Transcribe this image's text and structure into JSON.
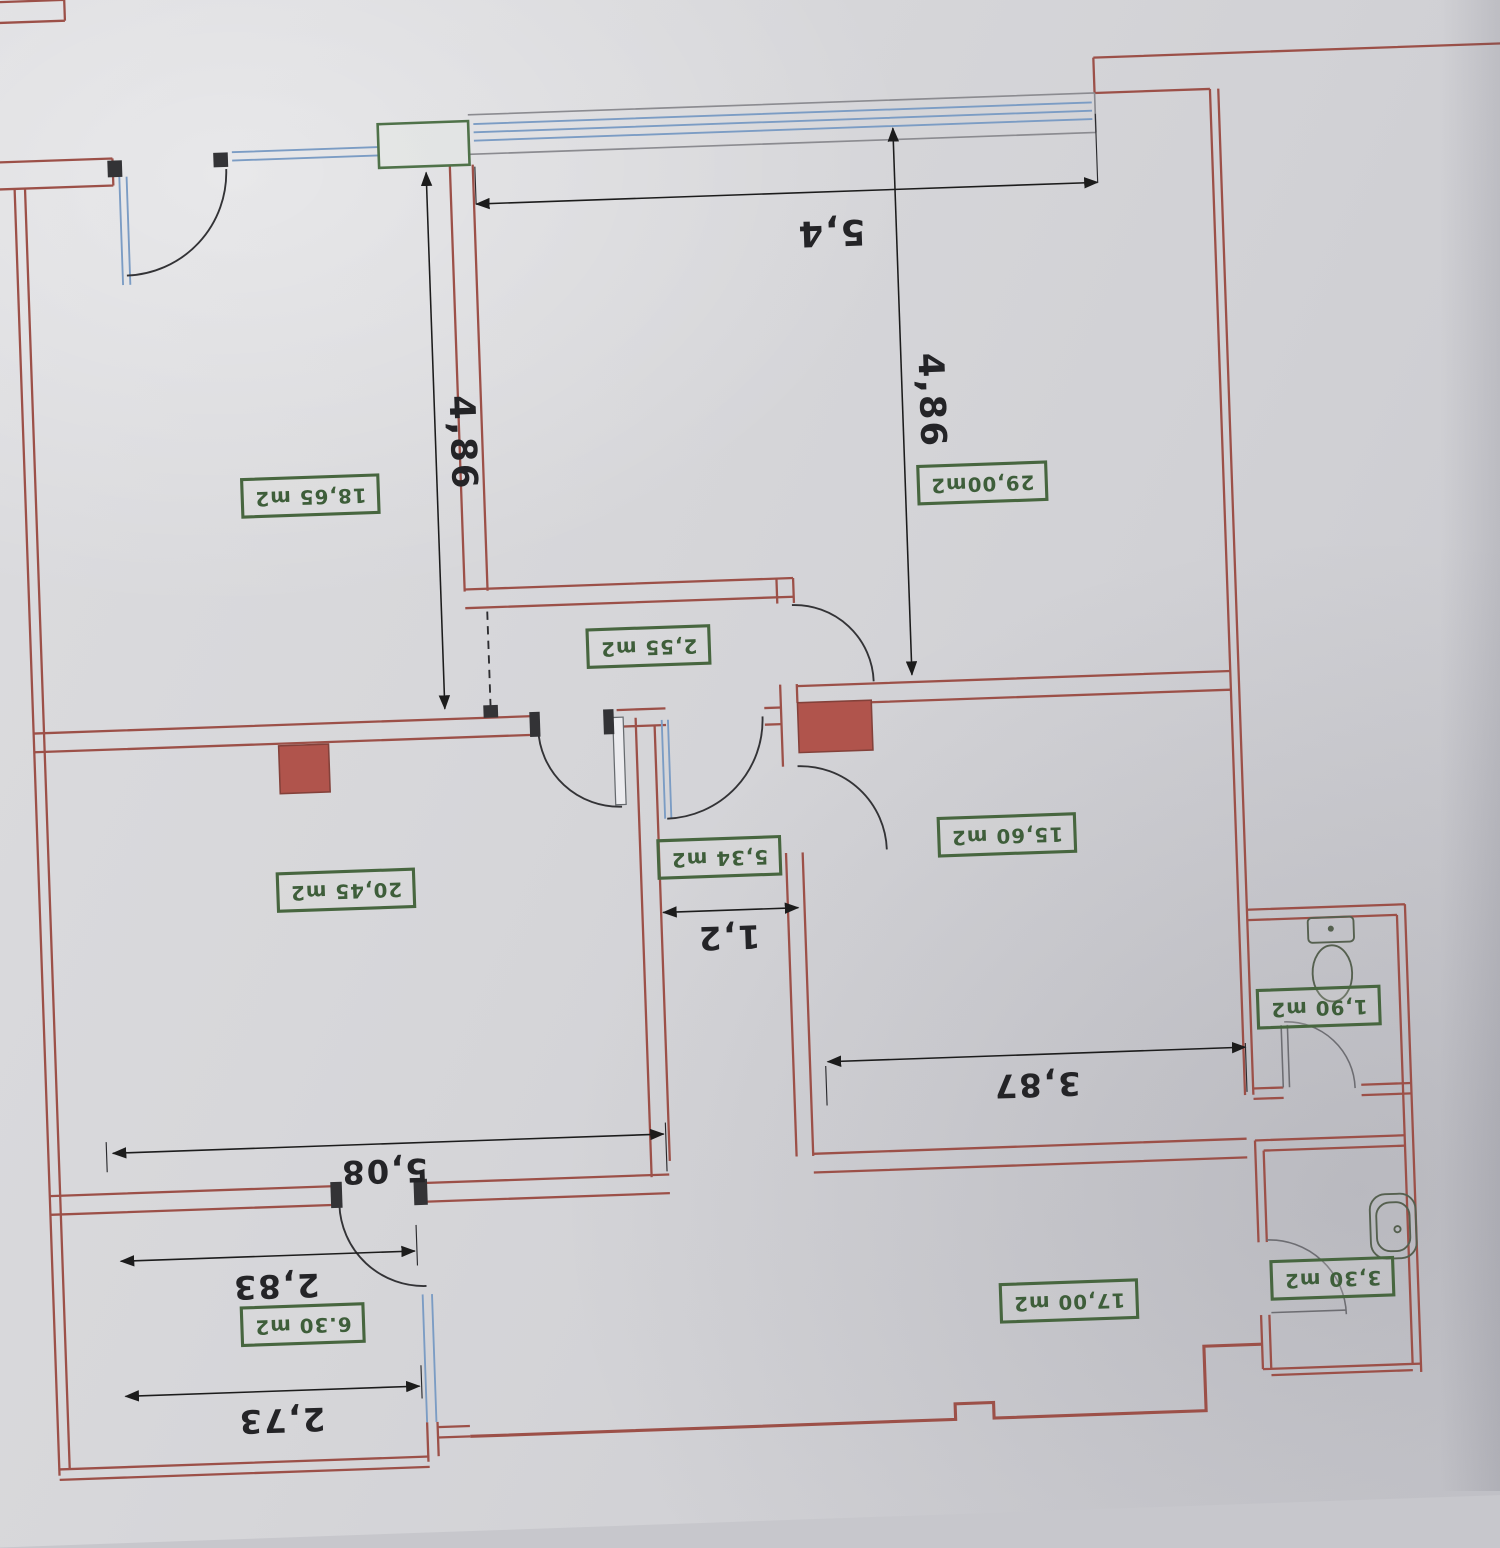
{
  "plan": {
    "rooms": [
      {
        "id": "room-1",
        "area_label": "18,65 m2"
      },
      {
        "id": "room-2",
        "area_label": "29,00m2"
      },
      {
        "id": "room-3",
        "area_label": "2,55 m2"
      },
      {
        "id": "room-4",
        "area_label": "20,45 m2"
      },
      {
        "id": "room-5",
        "area_label": "5,34 m2"
      },
      {
        "id": "room-6",
        "area_label": "15,60 m2"
      },
      {
        "id": "room-7",
        "area_label": "1,90 m2"
      },
      {
        "id": "room-8",
        "area_label": "17,00 m2"
      },
      {
        "id": "room-9",
        "area_label": "3,30 m2"
      },
      {
        "id": "room-10",
        "area_label": "6.30 m2"
      }
    ],
    "dimensions": [
      {
        "id": "dim-top-width",
        "label": "5,4"
      },
      {
        "id": "dim-right-height",
        "label": "4,86"
      },
      {
        "id": "dim-left-height",
        "label": "4,86"
      },
      {
        "id": "dim-corridor-width",
        "label": "1,2"
      },
      {
        "id": "dim-room-width-right",
        "label": "3,87"
      },
      {
        "id": "dim-room-width-left",
        "label": "5,08"
      },
      {
        "id": "dim-balcony-top",
        "label": "2,83"
      },
      {
        "id": "dim-balcony-bottom",
        "label": "2,73"
      }
    ],
    "fixtures": [
      {
        "name": "toilet"
      },
      {
        "name": "washbasin"
      }
    ],
    "colors": {
      "wall_red": "#9c5048",
      "label_green": "#47663f",
      "glazing_blue": "#7b9cc4",
      "shaft_fill": "#b0544c",
      "dimension_black": "#1f1f1f",
      "paper_gray": "#d6d6d9"
    }
  }
}
